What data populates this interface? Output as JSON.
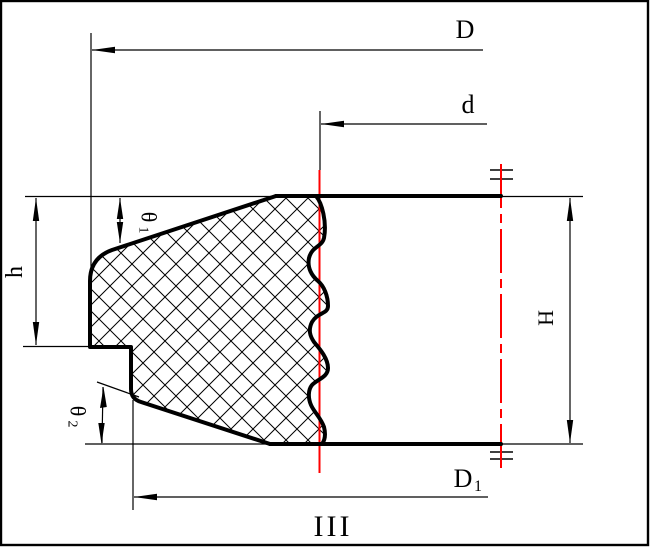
{
  "drawing": {
    "labels": {
      "outer_diameter": "D",
      "top_diameter": "d",
      "bottom_diameter_base": "D",
      "bottom_diameter_sub": "1",
      "shoulder_height": "h",
      "total_height": "H",
      "top_angle_base": "θ",
      "top_angle_sub": "1",
      "bottom_angle_base": "θ",
      "bottom_angle_sub": "2",
      "section_mark": "III"
    },
    "colors": {
      "line": "#000000",
      "reference_red": "#ff0000",
      "background": "#ffffff"
    }
  }
}
